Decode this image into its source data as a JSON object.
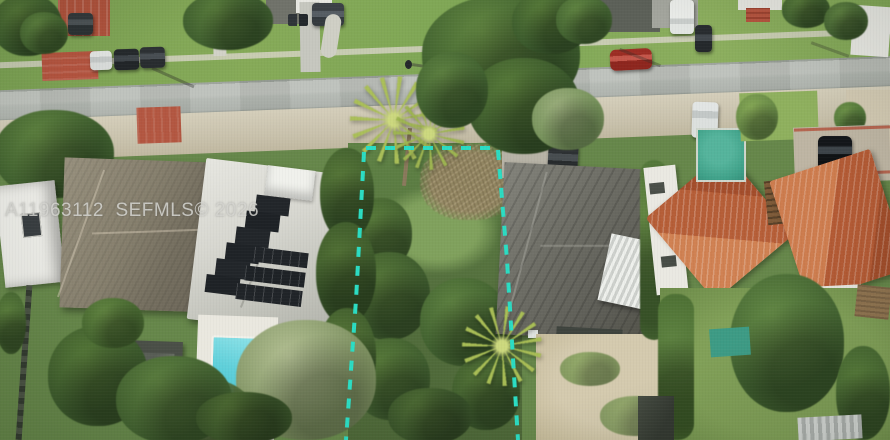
{
  "watermark": {
    "text": "A11963112  SEFMLS© 2026",
    "listing_id": "A11963112",
    "mls_name": "SEFMLS",
    "copyright_year": "2026"
  },
  "colors": {
    "lot_boundary": "#2bdcc3",
    "road_asphalt": "#b4b9b3",
    "vegetation_green": "#567a3c",
    "lawn_green": "#86aa58",
    "pool_water": "#55cdd9",
    "backyard_pool_green": "#3fa189",
    "red_pavement": "#b35741",
    "orange_tile_roof": "#c06a42",
    "gray_shingle_roof": "#867f6d",
    "dark_weathered_roof": "#66665e",
    "solar_panel_black": "#22262a",
    "sand_dirt": "#d0c8b2",
    "watermark_text": "#d6d6d1"
  },
  "scene": {
    "type": "aerial-drone-photo",
    "subject": "vacant residential lot outlined with a dashed teal property boundary",
    "features": [
      "street",
      "sidewalk",
      "parked-cars",
      "pedestrian",
      "vacant-lot",
      "palm-trees",
      "dry-dead-branches",
      "house-with-solar-panels",
      "swimming-pool",
      "gray-shingle-roof-house",
      "dark-roof-house-with-awning",
      "orange-tile-roof-houses",
      "white-shed",
      "red-paved-driveways",
      "backyard-lawns",
      "hedges"
    ]
  }
}
